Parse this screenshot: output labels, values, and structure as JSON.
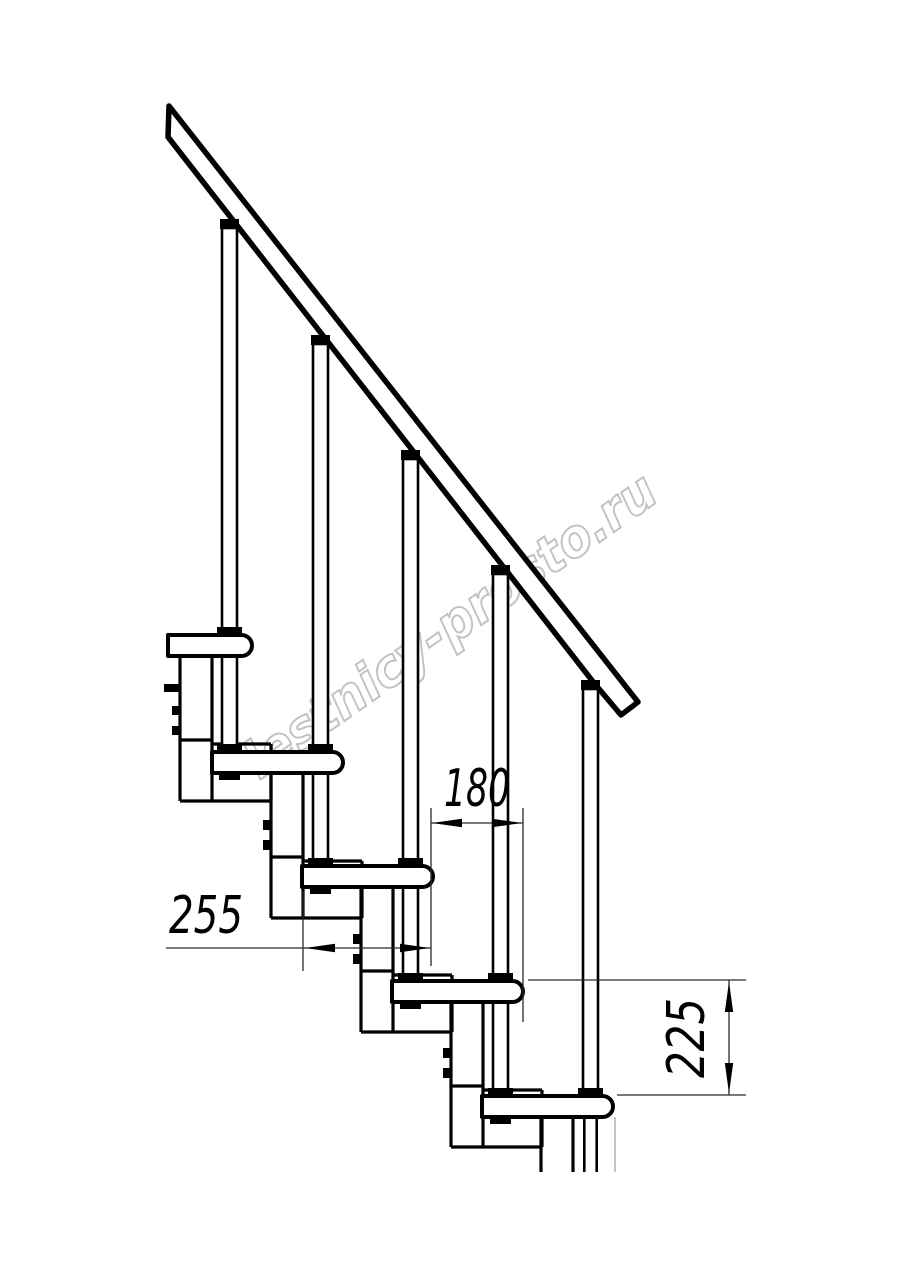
{
  "canvas": {
    "background": "#ffffff",
    "line_color": "#000000",
    "dimension_color": "#2b2b2b"
  },
  "dimensions": {
    "run": {
      "value": "180",
      "orientation": "horizontal"
    },
    "tread_depth": {
      "value": "255",
      "orientation": "horizontal"
    },
    "rise": {
      "value": "225",
      "orientation": "vertical"
    }
  },
  "watermark": {
    "text": "lestnicy-prosto.ru",
    "color": "#c2c2c2"
  }
}
